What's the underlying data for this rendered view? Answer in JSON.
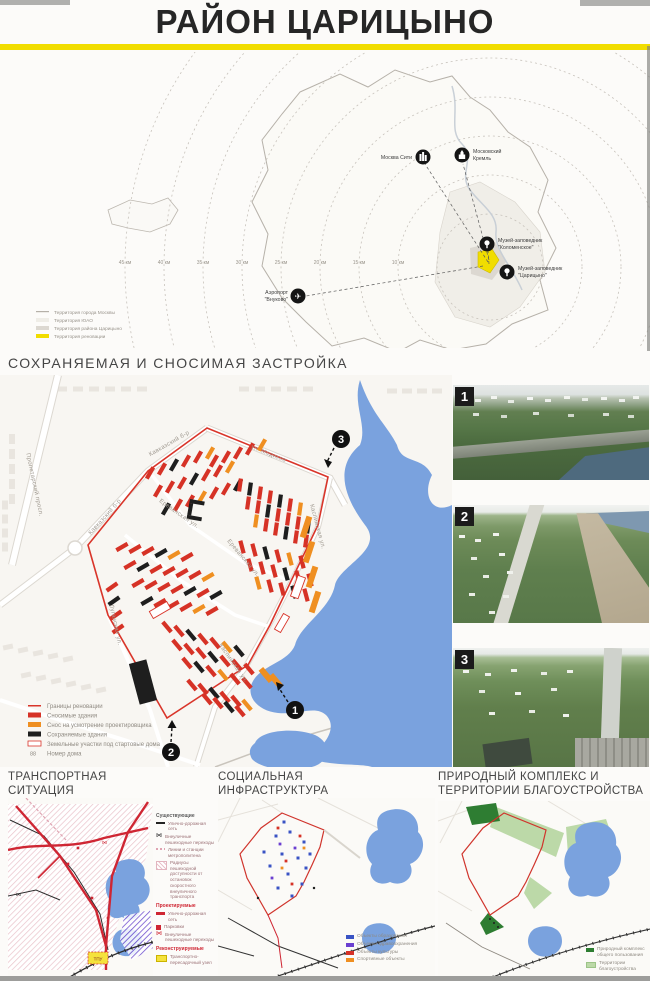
{
  "page": {
    "title": "РАЙОН ЦАРИЦЫНО"
  },
  "overview": {
    "distances": [
      "45 км",
      "40 км",
      "35 км",
      "30 км",
      "25 км",
      "20 км",
      "15 км",
      "10 км"
    ],
    "pois": [
      {
        "line1": "Москва Сити",
        "line2": "",
        "icon": "skyscraper"
      },
      {
        "line1": "Московский",
        "line2": "Кремль",
        "icon": "kremlin"
      },
      {
        "line1": "Музей-заповедник",
        "line2": "\"Коломенское\"",
        "icon": "park"
      },
      {
        "line1": "Музей-заповедник",
        "line2": "\"Царицыно\"",
        "icon": "park"
      },
      {
        "line1": "Аэропорт",
        "line2": "\"Внуково\"",
        "icon": "airplane"
      }
    ],
    "legend": [
      {
        "label": "Территория города Москвы"
      },
      {
        "label": "Территория ЮАО"
      },
      {
        "label": "Территория района Царицыно"
      },
      {
        "label": "Территория реновации"
      }
    ],
    "colors": {
      "renovation_yellow": "#f1dd00"
    }
  },
  "demolition": {
    "title": "СОХРАНЯЕМАЯ И СНОСИМАЯ ЗАСТРОЙКА",
    "streets": {
      "proletarsky": "Пролетарский просп.",
      "kavkazsky": "Кавказский б-р",
      "medikov": "ул. Медиков",
      "erevanskaya": "Ереванская ул.",
      "kaspiyskaya": "Каспийская ул.",
      "luganskaya": "Луганская ул."
    },
    "markers": [
      "1",
      "2",
      "3"
    ],
    "legend": [
      {
        "label": "Границы реновации"
      },
      {
        "label": "Сносимые здания"
      },
      {
        "label": "Снос на усмотрение проектировщика"
      },
      {
        "label": "Сохраняемые здания"
      },
      {
        "label": "Земельные участки под стартовые дома"
      },
      {
        "label": "Номер дома",
        "swatch_text": "88"
      }
    ],
    "colors": {
      "demolish_red": "#d63226",
      "keep_black": "#1e1e1e",
      "discretion_orange": "#ef8f21",
      "lake_blue": "#7aa2de"
    }
  },
  "photos": [
    "1",
    "2",
    "3"
  ],
  "transport": {
    "title1": "ТРАНСПОРТНАЯ",
    "title2": "СИТУАЦИЯ",
    "tpu": "ТПУ",
    "legend": {
      "existing_header": "Существующие",
      "existing": [
        "Улично-дорожная сеть",
        "Внеуличные пешеходные переходы",
        "Линии и станции метрополитена",
        "Радиусы пешеходной доступности от остановок скоростного внеуличного транспорта"
      ],
      "planned_header": "Проектируемые",
      "planned": [
        "Улично-дорожная сеть",
        "Парковки",
        "Внеуличные пешеходные переходы"
      ],
      "recon_header": "Реконструируемые",
      "recon": [
        "Транспортно-пересадочный узел"
      ]
    }
  },
  "social": {
    "title1": "СОЦИАЛЬНАЯ",
    "title2": "ИНФРАСТРУКТУРА",
    "legend": [
      {
        "label": "Объекты образования",
        "color": "#3953c4"
      },
      {
        "label": "Объекты здравоохранения",
        "color": "#6a3fd0"
      },
      {
        "label": "Объекты культуры",
        "color": "#d63226"
      },
      {
        "label": "Спортивные объекты",
        "color": "#ef8f21"
      }
    ]
  },
  "nature": {
    "title1": "ПРИРОДНЫЙ КОМПЛЕКС И",
    "title2": "ТЕРРИТОРИИ БЛАГОУСТРОЙСТВА",
    "legend": [
      {
        "label": "Природный комплекс общего пользования",
        "color": "#2e7d32"
      },
      {
        "label": "Территории благоустройства",
        "color": "#bcd9a8"
      }
    ]
  }
}
